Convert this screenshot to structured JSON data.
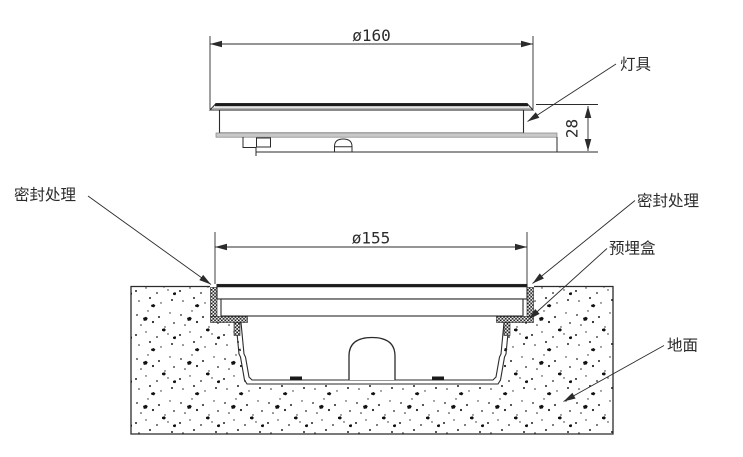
{
  "page": {
    "background": "#ffffff",
    "line_color": "#2b2b2b"
  },
  "side_view": {
    "dim_diameter": "ø160",
    "dim_height": "28",
    "callout_lamp": "灯具"
  },
  "section_view": {
    "dim_diameter": "ø155",
    "callout_seal_left": "密封处理",
    "callout_seal_right": "密封处理",
    "callout_embedded_box": "预埋盒",
    "callout_ground": "地面"
  }
}
